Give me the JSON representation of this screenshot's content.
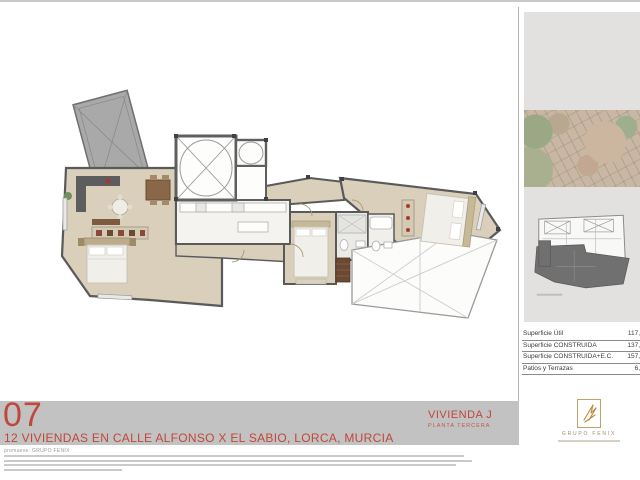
{
  "sheet": {
    "number": "07",
    "title": "12 VIVIENDAS EN CALLE ALFONSO X EL SABIO, LORCA, MURCIA",
    "unit": "VIVIENDA J",
    "floor": "PLANTA TERCERA",
    "promoter_line": "promueve: GRUPO FENIX",
    "fine_print_note": "three lines of small legal text, illegible at this resolution"
  },
  "areas_table": {
    "rows": [
      {
        "label": "Superficie Útil",
        "value": "117,"
      },
      {
        "label": "Superficie CONSTRUIDA",
        "value": "137,"
      },
      {
        "label": "Superficie CONSTRUIDA+E.C.",
        "value": "157,"
      },
      {
        "label": "Patios y Terrazas",
        "value": "6,"
      }
    ]
  },
  "sidebar": {
    "map": "aerial-photo-of-lorca",
    "keyplan": "building-footprint-with-unit-highlighted"
  },
  "logo": {
    "name": "GRUPO FENIX"
  },
  "colors": {
    "accent_red": "#c0473b",
    "band_gray": "#c2c2c2",
    "panel_gray": "#e2e1df",
    "floor_beige": "#d9cfba",
    "wall_gray": "#5a5a5a",
    "logo_gold": "#b9893f"
  }
}
